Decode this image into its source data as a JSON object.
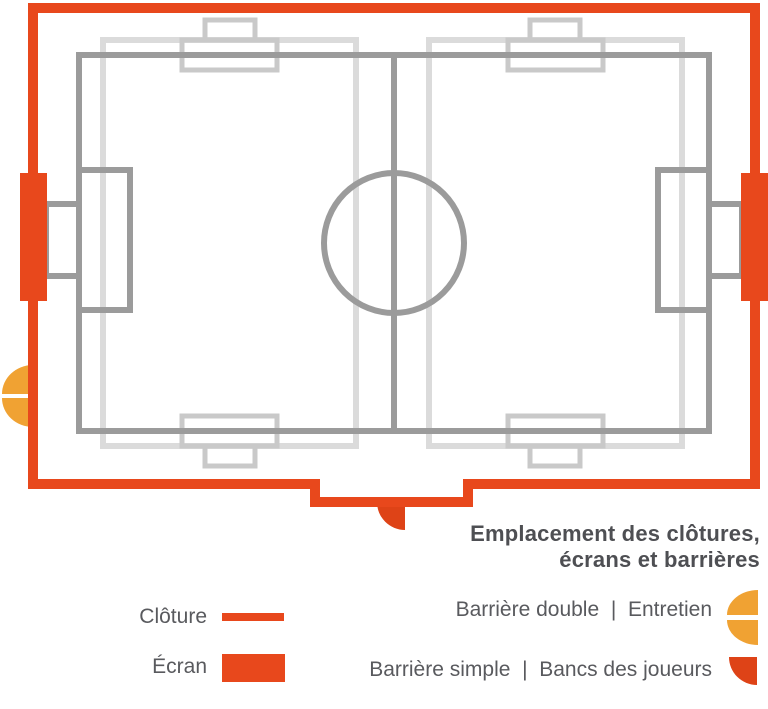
{
  "title": {
    "line1": "Emplacement des clôtures,",
    "line2": "écrans et barrières"
  },
  "legend": {
    "cloture": {
      "label": "Clôture",
      "swatch": "orange-thick-line"
    },
    "ecran": {
      "label": "Écran",
      "swatch": "orange-filled-rect"
    },
    "barriere_double": {
      "label": "Barrière double  |  Entretien",
      "swatch": "amber-split-half-disc"
    },
    "barriere_simple": {
      "label": "Barrière simple  |  Bancs des joueurs",
      "swatch": "red-quarter-disc"
    }
  },
  "diagram": {
    "description_elements": {
      "fence": "orange enclosure outline with bottom notch",
      "screens": "left and right orange rectangles on fence",
      "main_pitch": "dark gray 11v11 pitch with halfway line, centre circle, penalty areas and goals",
      "cross_pitches": "two light gray crosswise pitches with goal areas and goals top and bottom",
      "barrier_double_marker": "amber split half-disc on left fence",
      "barrier_simple_marker": "red quarter-disc in bottom fence notch"
    }
  },
  "colors": {
    "fence": "#E8481C",
    "screen": "#E8481C",
    "barrier_double": "#F0A233",
    "barrier_simple": "#DE4317",
    "pitch_main_line": "#9B9B9B",
    "pitch_cross_line": "#DBDBDB",
    "pitch_cross_goal": "#C9C9C9",
    "title_text": "#4E4F53",
    "legend_text": "#595A5E",
    "background": "#FFFFFF"
  }
}
